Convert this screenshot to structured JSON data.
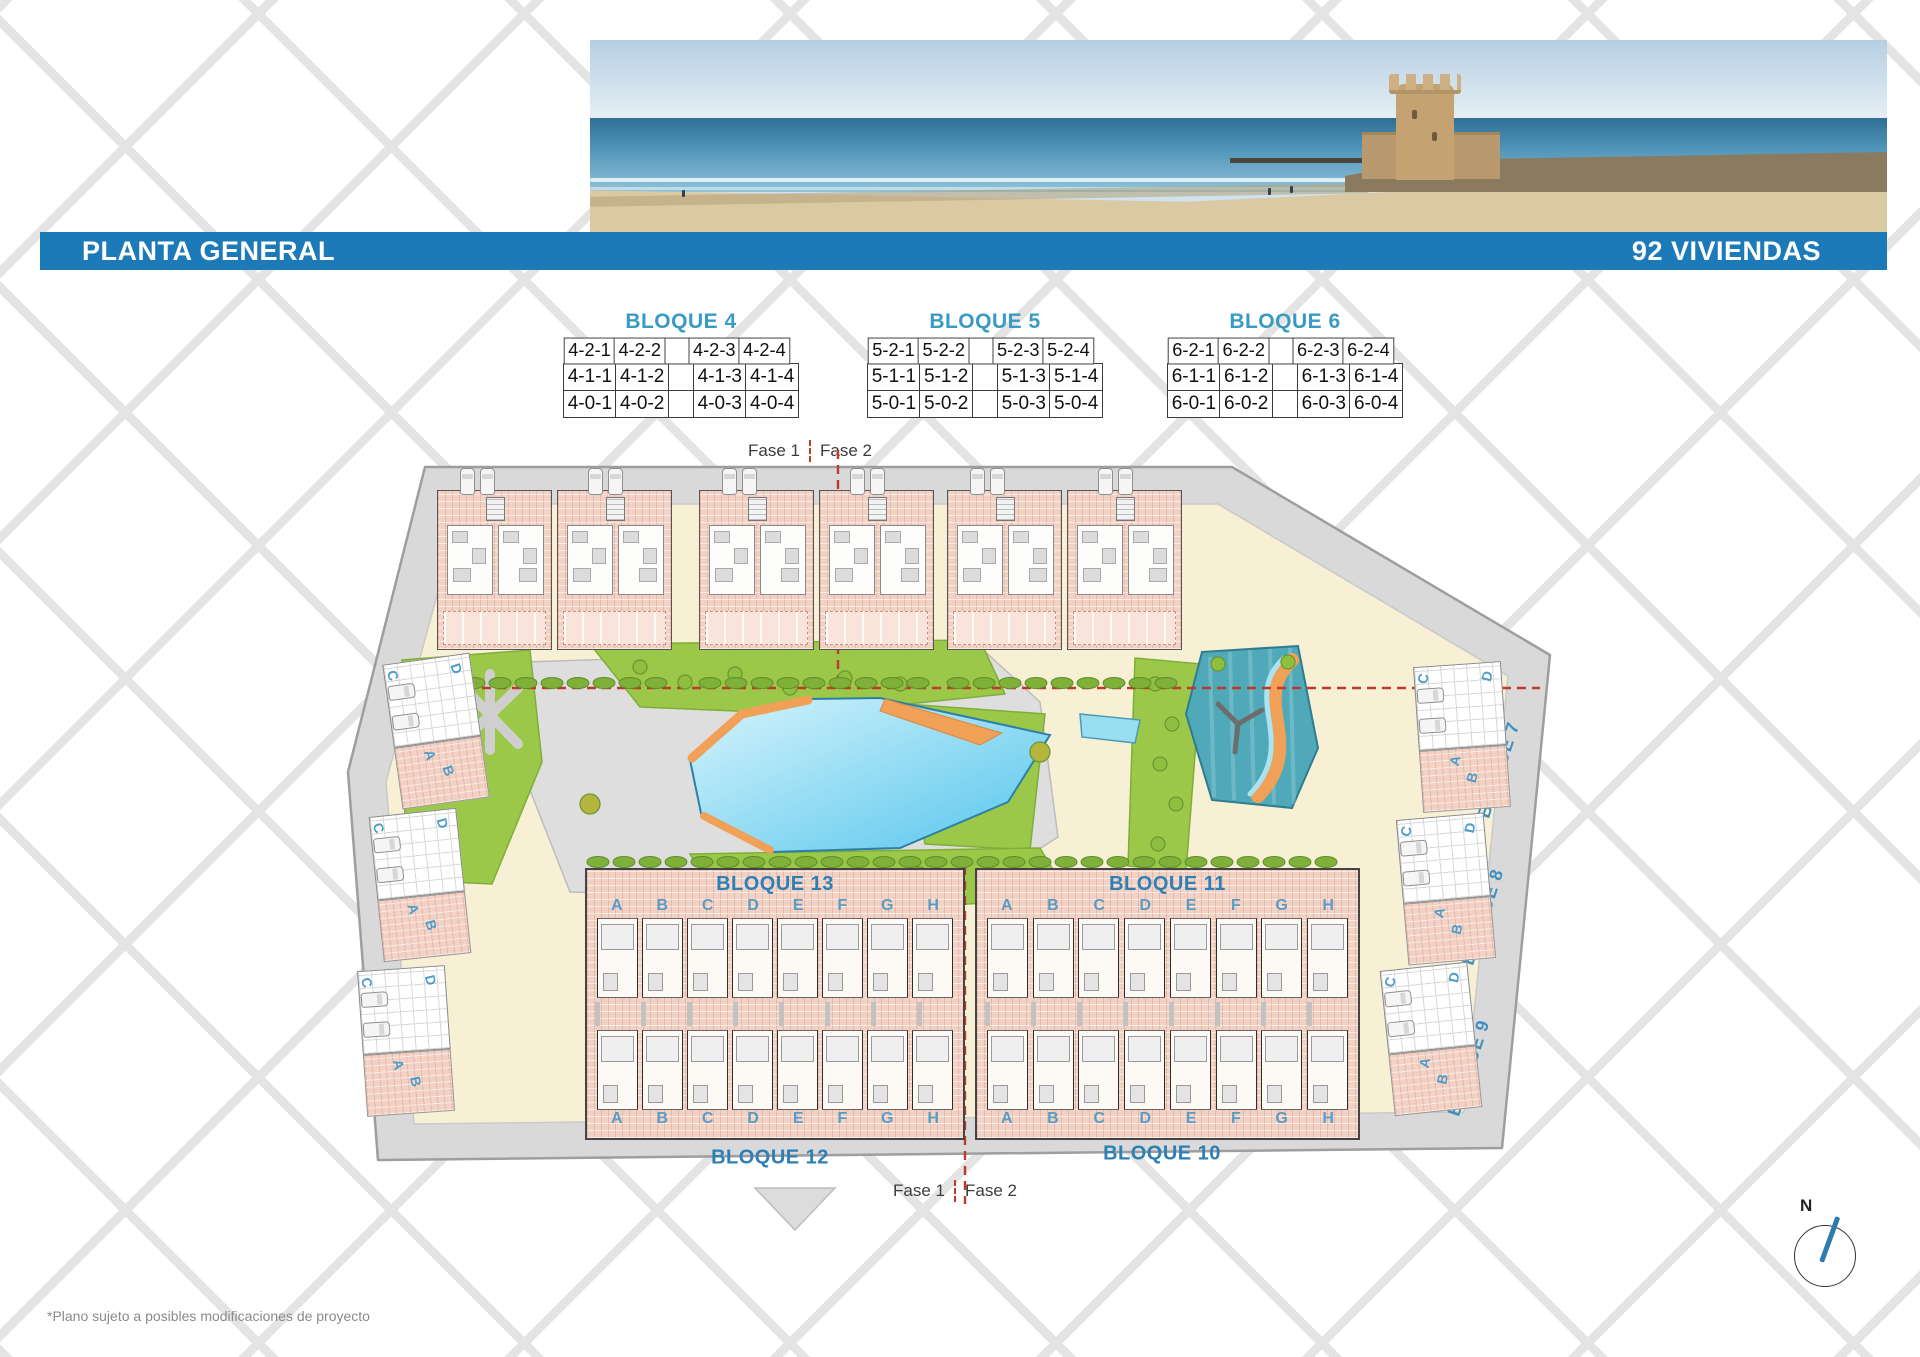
{
  "header": {
    "title": "PLANTA GENERAL",
    "units_label": "92 VIVIENDAS"
  },
  "block_tables": [
    {
      "title": "BLOQUE 4",
      "rows": [
        [
          "4-2-1",
          "4-2-2",
          "",
          "4-2-3",
          "4-2-4"
        ],
        [
          "4-1-1",
          "4-1-2",
          "",
          "4-1-3",
          "4-1-4"
        ],
        [
          "4-0-1",
          "4-0-2",
          "",
          "4-0-3",
          "4-0-4"
        ]
      ]
    },
    {
      "title": "BLOQUE 5",
      "rows": [
        [
          "5-2-1",
          "5-2-2",
          "",
          "5-2-3",
          "5-2-4"
        ],
        [
          "5-1-1",
          "5-1-2",
          "",
          "5-1-3",
          "5-1-4"
        ],
        [
          "5-0-1",
          "5-0-2",
          "",
          "5-0-3",
          "5-0-4"
        ]
      ]
    },
    {
      "title": "BLOQUE 6",
      "rows": [
        [
          "6-2-1",
          "6-2-2",
          "",
          "6-2-3",
          "6-2-4"
        ],
        [
          "6-1-1",
          "6-1-2",
          "",
          "6-1-3",
          "6-1-4"
        ],
        [
          "6-0-1",
          "6-0-2",
          "",
          "6-0-3",
          "6-0-4"
        ]
      ]
    }
  ],
  "phase_labels": {
    "left": "Fase 1",
    "right": "Fase 2"
  },
  "site_plan": {
    "row_blocks": [
      {
        "top_label": "BLOQUE 13",
        "bottom_label": "BLOQUE 12"
      },
      {
        "top_label": "BLOQUE 11",
        "bottom_label": "BLOQUE 10"
      }
    ],
    "unit_letters": [
      "A",
      "B",
      "C",
      "D",
      "E",
      "F",
      "G",
      "H"
    ],
    "left_road_labels": [
      "BLOQUE 3",
      "BLOQUE 2",
      "BLOQUE 1"
    ],
    "right_road_labels": [
      "BLOQUE 7",
      "BLOQUE 8",
      "BLOQUE 9"
    ],
    "side_unit_letters": [
      "A",
      "B",
      "C",
      "D"
    ]
  },
  "compass": {
    "north_label": "N"
  },
  "footnote": "*Plano sujeto a posibles modificaciones de proyecto",
  "colors": {
    "header_bar": "#1d7ab8",
    "label_blue": "#3e90c0",
    "phase_red": "#bf3a2b",
    "building_pink": "#f3d2c6",
    "lawn_green": "#9cc84a",
    "pool_blue": "#55c5ec",
    "splash_teal": "#4fa9b9",
    "river_orange": "#f0a057"
  }
}
